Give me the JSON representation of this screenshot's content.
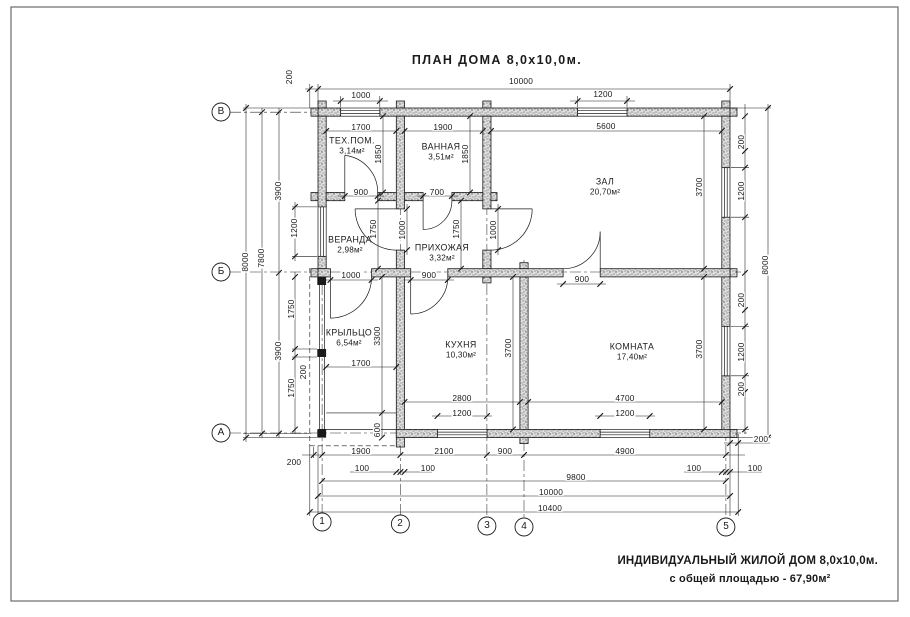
{
  "title": "ПЛАН  ДОМА  8,0x10,0м.",
  "footer": {
    "line1": "ИНДИВИДУАЛЬНЫЙ ЖИЛОЙ  ДОМ  8,0x10,0м.",
    "line2": "с общей площадью - 67,90м²"
  },
  "axes": {
    "rows": [
      "В",
      "Б",
      "А"
    ],
    "cols": [
      "1",
      "2",
      "3",
      "4",
      "5"
    ]
  },
  "rooms": [
    {
      "name": "ТЕХ.ПОМ.",
      "area": "3,14м²"
    },
    {
      "name": "ВАННАЯ",
      "area": "3,51м²"
    },
    {
      "name": "ЗАЛ",
      "area": "20,70м²"
    },
    {
      "name": "ВЕРАНДА",
      "area": "2,98м²"
    },
    {
      "name": "ПРИХОЖАЯ",
      "area": "3,32м²"
    },
    {
      "name": "КРЫЛЬЦО",
      "area": "6,54м²"
    },
    {
      "name": "КУХНЯ",
      "area": "10,30м²"
    },
    {
      "name": "КОМНАТА",
      "area": "17,40м²"
    }
  ],
  "dims": {
    "top_200": "200",
    "top_1000": "1000",
    "top_10000": "10000",
    "top_1200": "1200",
    "left_8000": "8000",
    "left_7800": "7800",
    "left_3900a": "3900",
    "left_1200": "1200",
    "left_3900b": "3900",
    "left_1750a": "1750",
    "left_200": "200",
    "left_1750b": "1750",
    "right_200a": "200",
    "right_1200a": "1200",
    "right_8000": "8000",
    "right_200b": "200",
    "right_1200b": "1200",
    "right_200c": "200",
    "right_200d": "200",
    "bot_200": "200",
    "bot_1900": "1900",
    "bot_100a": "100",
    "bot_2100": "2100",
    "bot_100b": "100",
    "bot_900": "900",
    "bot_4900": "4900",
    "bot_100c": "100",
    "bot_100d": "100",
    "bot_9800": "9800",
    "bot_10000": "10000",
    "bot_10400": "10400",
    "i_1700t": "1700",
    "i_1850t": "1850",
    "i_1900": "1900",
    "i_1850b": "1850",
    "i_5600": "5600",
    "i_3700z": "3700",
    "i_900t": "900",
    "i_700": "700",
    "i_1750v": "1750",
    "i_1000v": "1000",
    "i_1750p": "1750",
    "i_1000p": "1000",
    "i_1000k": "1000",
    "i_900k": "900",
    "i_900z": "900",
    "i_3300": "3300",
    "i_1700p": "1700",
    "i_600": "600",
    "i_3700k": "3700",
    "i_3700r": "3700",
    "i_2800": "2800",
    "i_1200k": "1200",
    "i_4700": "4700",
    "i_1200r": "1200"
  }
}
